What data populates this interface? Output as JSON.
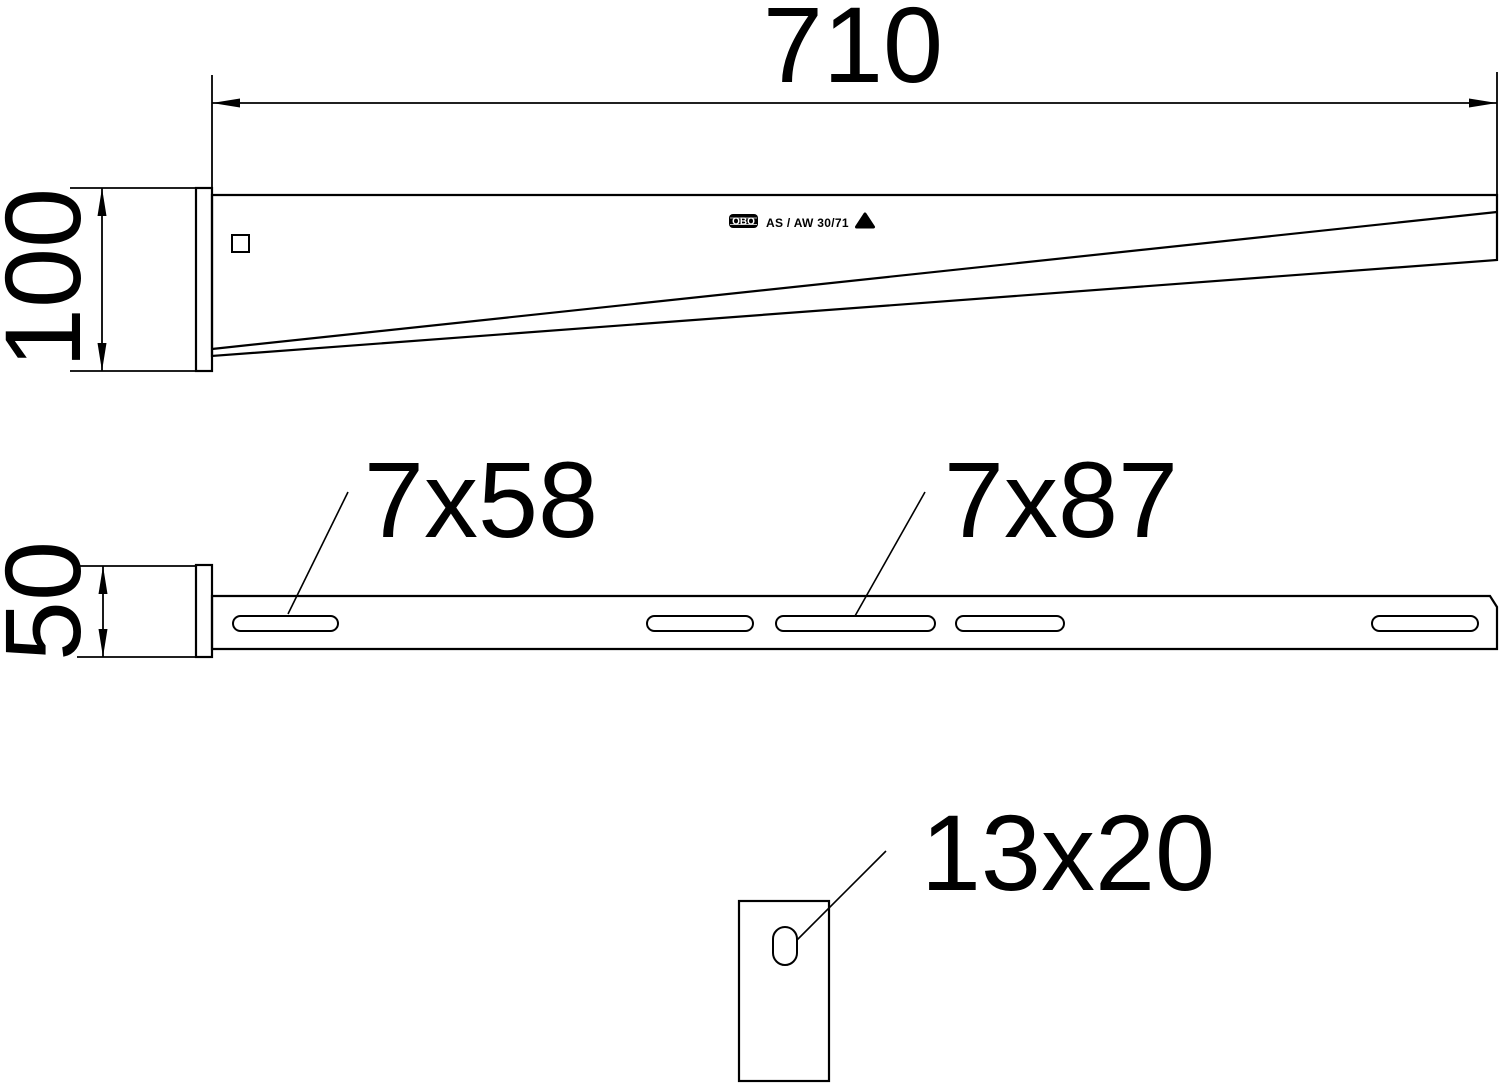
{
  "page": {
    "background": "#ffffff",
    "line_color": "#000000",
    "description": "Technical dimension drawing of a wall and support bracket"
  },
  "side_view": {
    "length_dim": "710",
    "height_dim": "100",
    "stamp_brand": "OBO",
    "stamp_code": "AS / AW 30/71"
  },
  "top_view": {
    "width_dim": "50",
    "slot_small_label": "7x58",
    "slot_large_label": "7x87"
  },
  "plate_view": {
    "hole_label": "13x20"
  }
}
